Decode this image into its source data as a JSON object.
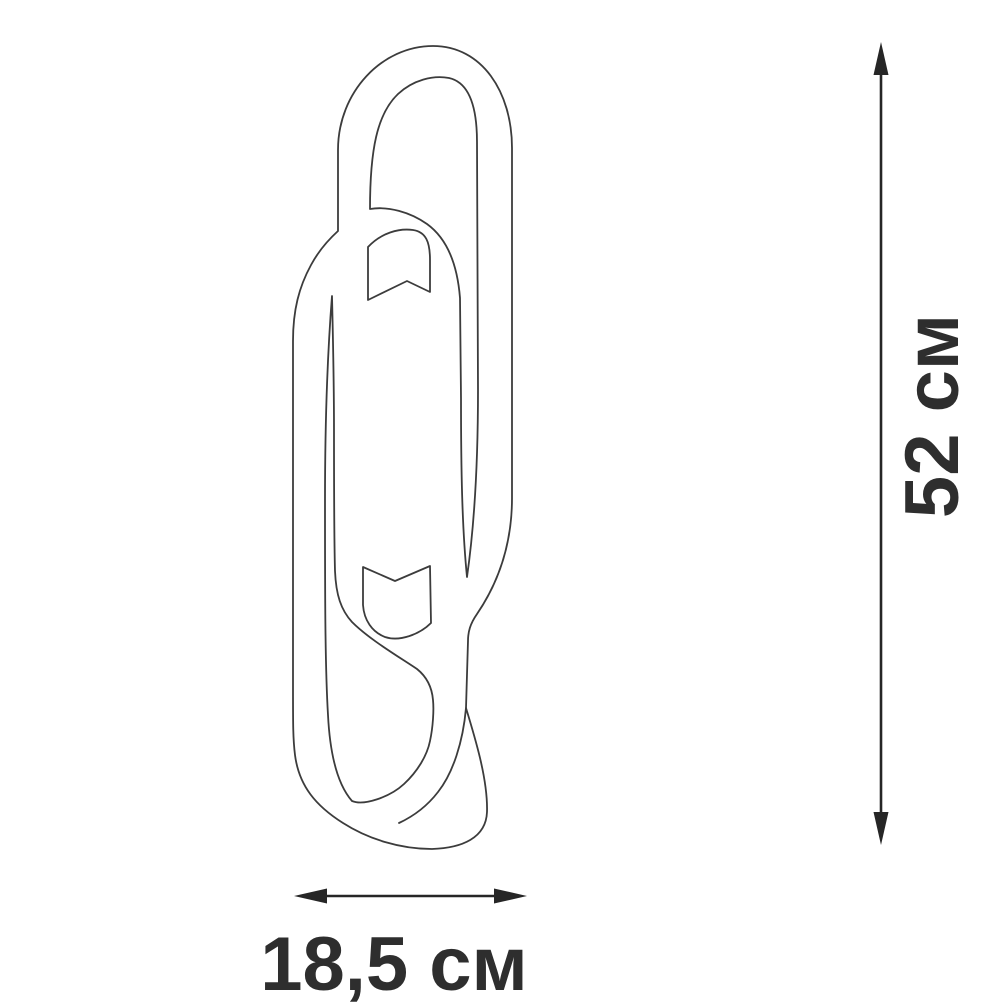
{
  "diagram": {
    "type": "product-dimension-drawing",
    "product": "wall-lamp-two-interlocked-oval-rings",
    "height_dimension": {
      "label": "52 см"
    },
    "width_dimension": {
      "label": "18,5 см"
    },
    "colors": {
      "background": "#ffffff",
      "outline": "#3c3c3c",
      "dimension_line": "#262626",
      "label_text": "#2e2e2e"
    }
  }
}
